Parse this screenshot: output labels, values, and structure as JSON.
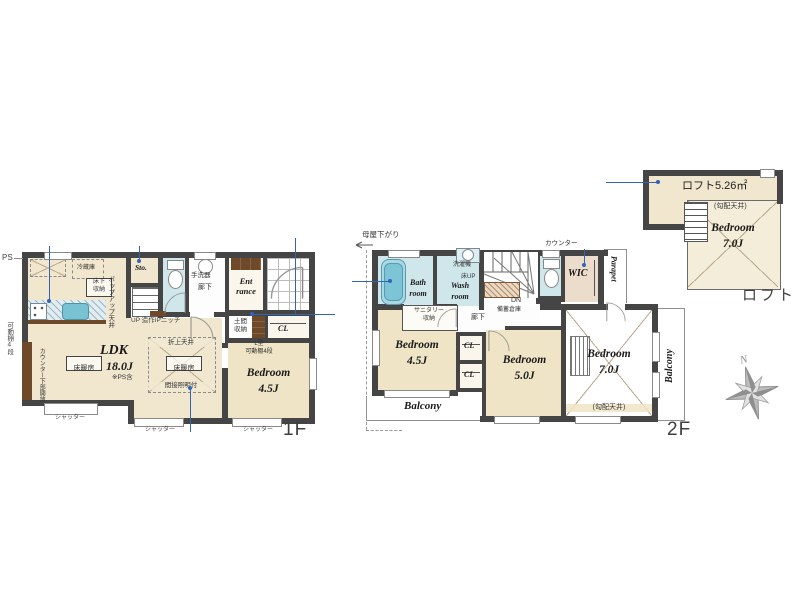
{
  "palette": {
    "wall": "#454545",
    "floor_beige": "#f1e7ce",
    "wet_blue": "#cfe6ea",
    "leader_blue": "#3265b5",
    "wood_brown": "#6e4a2a"
  },
  "floor1": {
    "label": "1F",
    "ldk": "LDK",
    "ldk_size": "18.0J",
    "ldk_note": "※PS含",
    "floor_heating": "床暖房",
    "oriage": "折上天井",
    "indirect": "間接照明付",
    "counter_open": "カウンター下部開放",
    "shelf4": "可動棚4段",
    "ps": "PS",
    "popup": "ポップアップ天井",
    "fridge": "冷蔵庫",
    "underfloor_l1": "床下",
    "underfloor_l2": "収納",
    "sto": "Sto.",
    "up_niche": "UP 造作IPニッチ",
    "handwash": "手洗器",
    "corridor": "廊下",
    "ent_l1": "Ent",
    "ent_l2": "rance",
    "doma_l1": "土間",
    "doma_l2": "収納",
    "cl": "CL",
    "lshelf_l1": "L型",
    "lshelf_l2": "可動棚4段",
    "bedroom": "Bedroom",
    "bedroom_size": "4.5J",
    "shutter": "シャッター"
  },
  "floor2": {
    "label": "2F",
    "moya": "母屋下がり",
    "bath_l1": "Bath",
    "bath_l2": "room",
    "wash_l1": "Wash",
    "wash_l2": "room",
    "washer": "洗濯機",
    "floor_up": "床UP",
    "dn": "DN",
    "stock": "備蓄倉庫",
    "counter": "カウンター",
    "wic": "WIC",
    "parapet": "Parapet",
    "corridor": "廊下",
    "sanitary_l1": "サニタリー",
    "sanitary_l2": "収納",
    "bedroom": "Bedroom",
    "b45": "4.5J",
    "b50": "5.0J",
    "b70": "7.0J",
    "cl": "CL",
    "slope": "(勾配天井)",
    "balcony": "Balcony"
  },
  "loft": {
    "label": "ロフト",
    "area": "ロフト5.26㎡",
    "bedroom": "Bedroom",
    "size": "7.0J",
    "slope": "(勾配天井)"
  },
  "compass": {
    "n": "N"
  }
}
